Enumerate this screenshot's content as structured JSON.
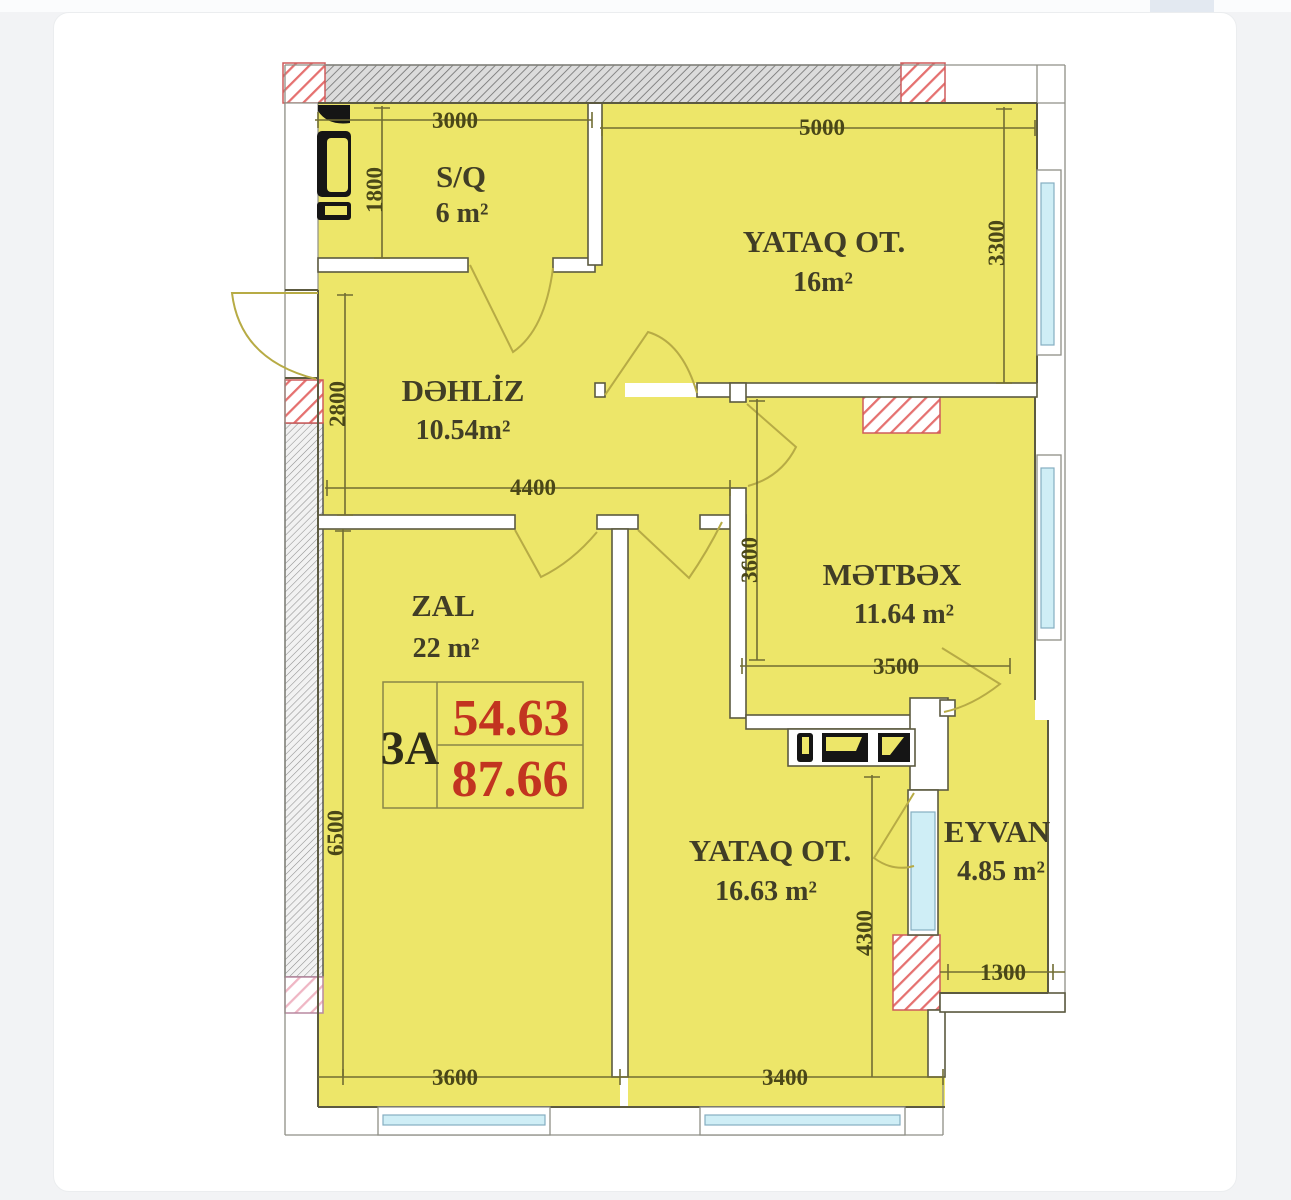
{
  "page": {
    "background": "#f2f3f5",
    "card_background": "#ffffff"
  },
  "plan": {
    "unit_badge": {
      "code": "3A",
      "upper_area": "54.63",
      "lower_area": "87.66"
    },
    "rooms": [
      {
        "id": "sq",
        "name": "S/Q",
        "area": "6 m²"
      },
      {
        "id": "bedroom1",
        "name": "YATAQ OT.",
        "area": "16m²"
      },
      {
        "id": "hallway",
        "name": "DƏHLİZ",
        "area": "10.54m²"
      },
      {
        "id": "kitchen",
        "name": "MƏTBƏX",
        "area": "11.64 m²"
      },
      {
        "id": "zal",
        "name": "ZAL",
        "area": "22 m²"
      },
      {
        "id": "bedroom2",
        "name": "YATAQ OT.",
        "area": "16.63 m²"
      },
      {
        "id": "eyvan",
        "name": "EYVAN",
        "area": "4.85 m²"
      }
    ],
    "dimensions": {
      "sq_width": "3000",
      "sq_height": "1800",
      "bedroom1_width": "5000",
      "bedroom1_height": "3300",
      "hallway_height": "2800",
      "hallway_width": "4400",
      "kitchen_height": "3600",
      "kitchen_width": "3500",
      "left_total_height": "6500",
      "bedroom2_height": "4300",
      "eyvan_width": "1300",
      "bottom_left_width": "3600",
      "bottom_right_width": "3400"
    },
    "colors": {
      "room_fill": "#ede669",
      "wall_line": "#5c5a40",
      "label_text": "#413e26",
      "dimension_text": "#4a4718",
      "accent_red": "#c23420",
      "window_glass": "#cfeef6",
      "hatch_red": "#e5706f",
      "hatch_pink": "#efb6c4",
      "hatch_gray": "#8f8f8f"
    }
  }
}
